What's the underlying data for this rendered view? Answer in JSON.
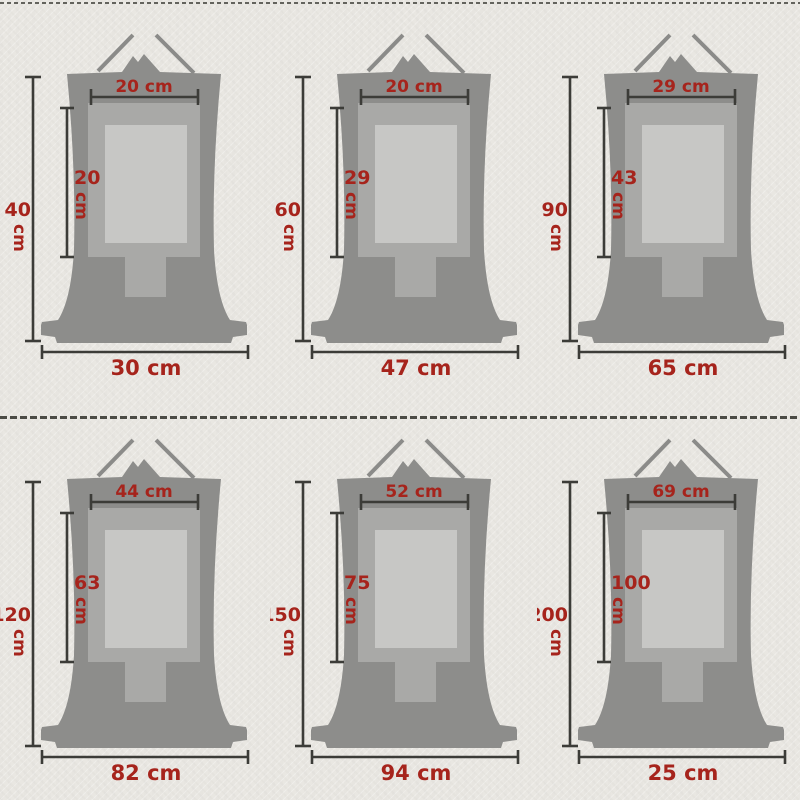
{
  "unit": "cm",
  "colors": {
    "background": "#e9e7e2",
    "scroll_body": "#8d8d8b",
    "mount_frame": "#a9a9a7",
    "art_panel": "#c7c7c5",
    "dimension_line": "#3c3c38",
    "label_red": "#a6241c",
    "stitch_divider": "#4b4b45"
  },
  "items": [
    {
      "name": "scroll-40cm",
      "total_height": "40",
      "top_width": "20 cm",
      "panel_height": "20",
      "bottom_width": "30 cm"
    },
    {
      "name": "scroll-60cm",
      "total_height": "60",
      "top_width": "20 cm",
      "panel_height": "29",
      "bottom_width": "47 cm"
    },
    {
      "name": "scroll-90cm",
      "total_height": "90",
      "top_width": "29 cm",
      "panel_height": "43",
      "bottom_width": "65 cm"
    },
    {
      "name": "scroll-120cm",
      "total_height": "120",
      "top_width": "44 cm",
      "panel_height": "63",
      "bottom_width": "82 cm"
    },
    {
      "name": "scroll-150cm",
      "total_height": "150",
      "top_width": "52 cm",
      "panel_height": "75",
      "bottom_width": "94 cm"
    },
    {
      "name": "scroll-200cm",
      "total_height": "200",
      "top_width": "69 cm",
      "panel_height": "100",
      "bottom_width": "25 cm"
    }
  ]
}
